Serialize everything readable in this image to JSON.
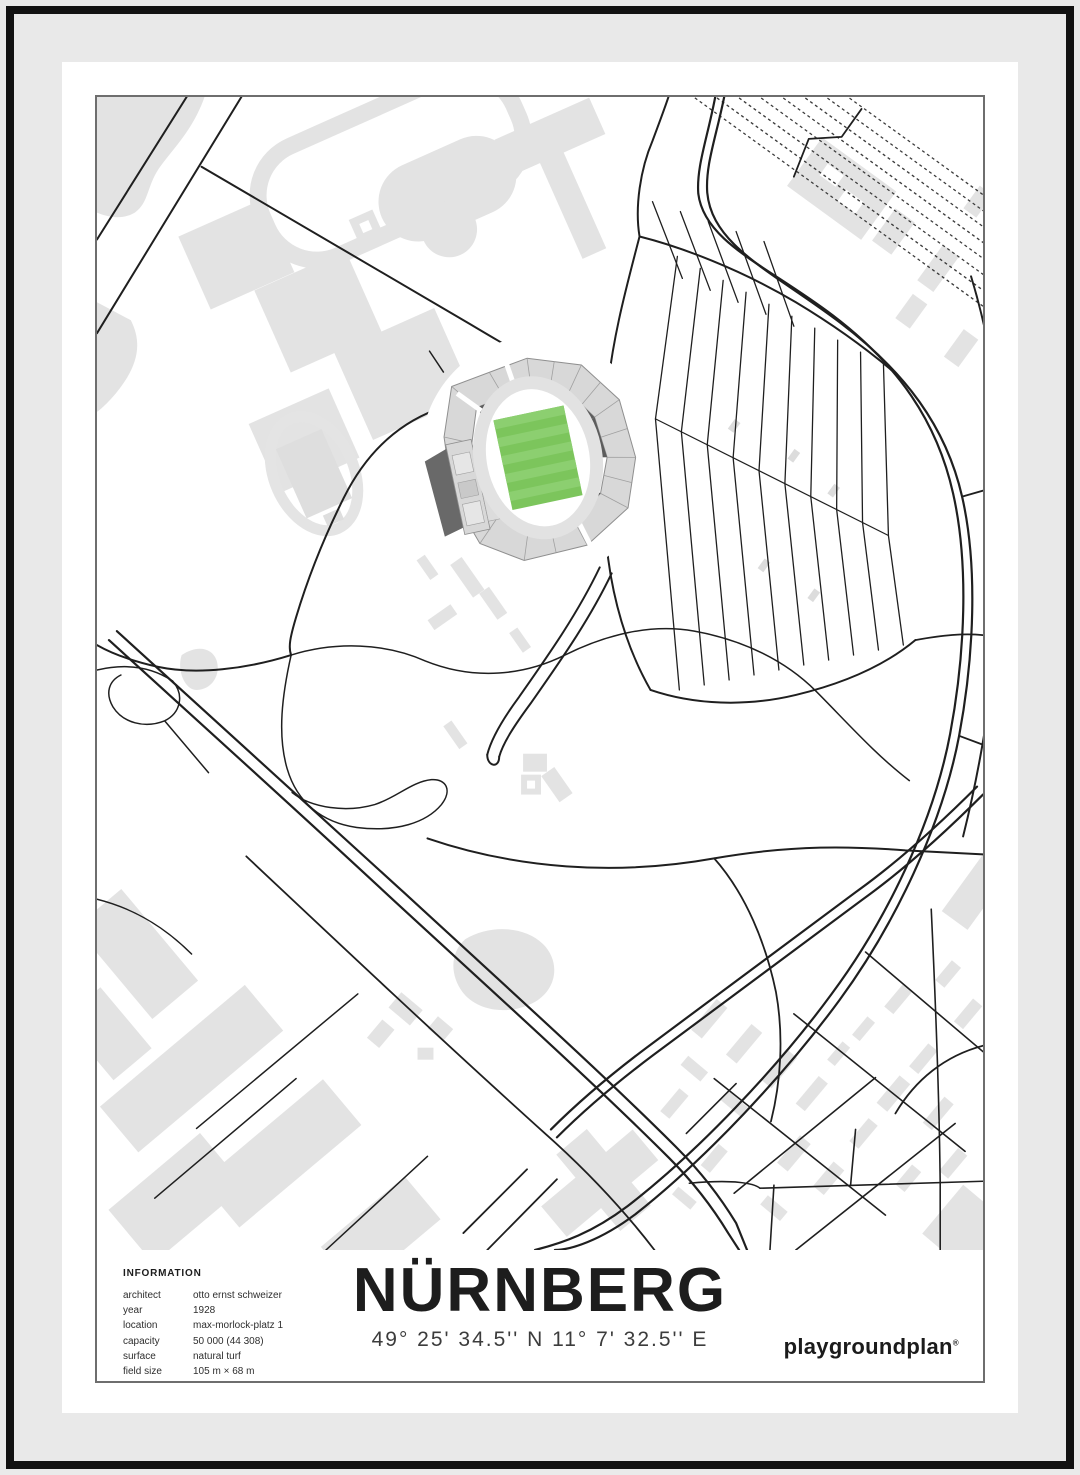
{
  "poster": {
    "title": "NÜRNBERG",
    "coordinates": "49° 25' 34.5'' N  11° 7' 32.5'' E",
    "brand": "playgroundplan",
    "brand_mark": "®",
    "info": {
      "heading": "INFORMATION",
      "rows": [
        {
          "label": "architect",
          "value": "otto ernst schweizer"
        },
        {
          "label": "year",
          "value": "1928"
        },
        {
          "label": "location",
          "value": "max-morlock-platz 1"
        },
        {
          "label": "capacity",
          "value": "50 000 (44 308)"
        },
        {
          "label": "surface",
          "value": "natural turf"
        },
        {
          "label": "field size",
          "value": "105 m × 68 m"
        }
      ]
    },
    "colors": {
      "pitch_green": "#7cc55c",
      "pitch_green_light": "#8ccf70",
      "building_gray": "#e3e3e3",
      "road_black": "#1f1f1f",
      "frame_black": "#121212",
      "mat_gray": "#e9e9e9",
      "stand_gray": "#d8d8d8",
      "stand_dark": "#5c5c5c"
    }
  }
}
